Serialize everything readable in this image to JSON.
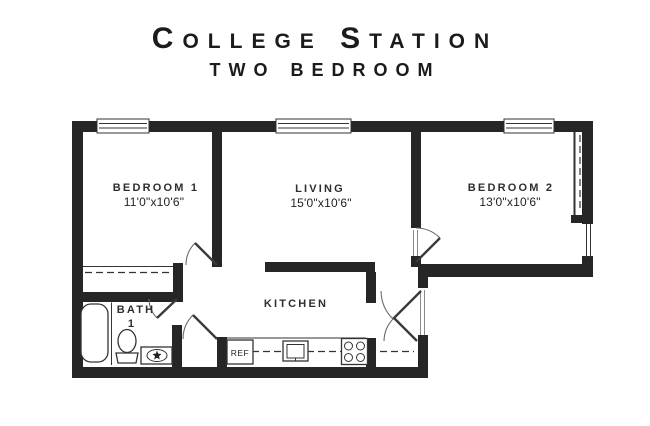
{
  "title": {
    "line1": "College Station",
    "line2": "two bedroom"
  },
  "rooms": {
    "bedroom1": {
      "name": "BEDROOM 1",
      "dimensions": "11'0\"x10'6\""
    },
    "living": {
      "name": "LIVING",
      "dimensions": "15'0\"x10'6\""
    },
    "bedroom2": {
      "name": "BEDROOM 2",
      "dimensions": "13'0\"x10'6\""
    },
    "kitchen": {
      "name": "KITCHEN"
    },
    "bath": {
      "name": "BATH",
      "number": "1"
    }
  },
  "appliances": {
    "refrigerator_label": "REF"
  },
  "colors": {
    "wall": "#262626",
    "line": "#333333",
    "text": "#2e2e2e",
    "background": "#ffffff"
  }
}
